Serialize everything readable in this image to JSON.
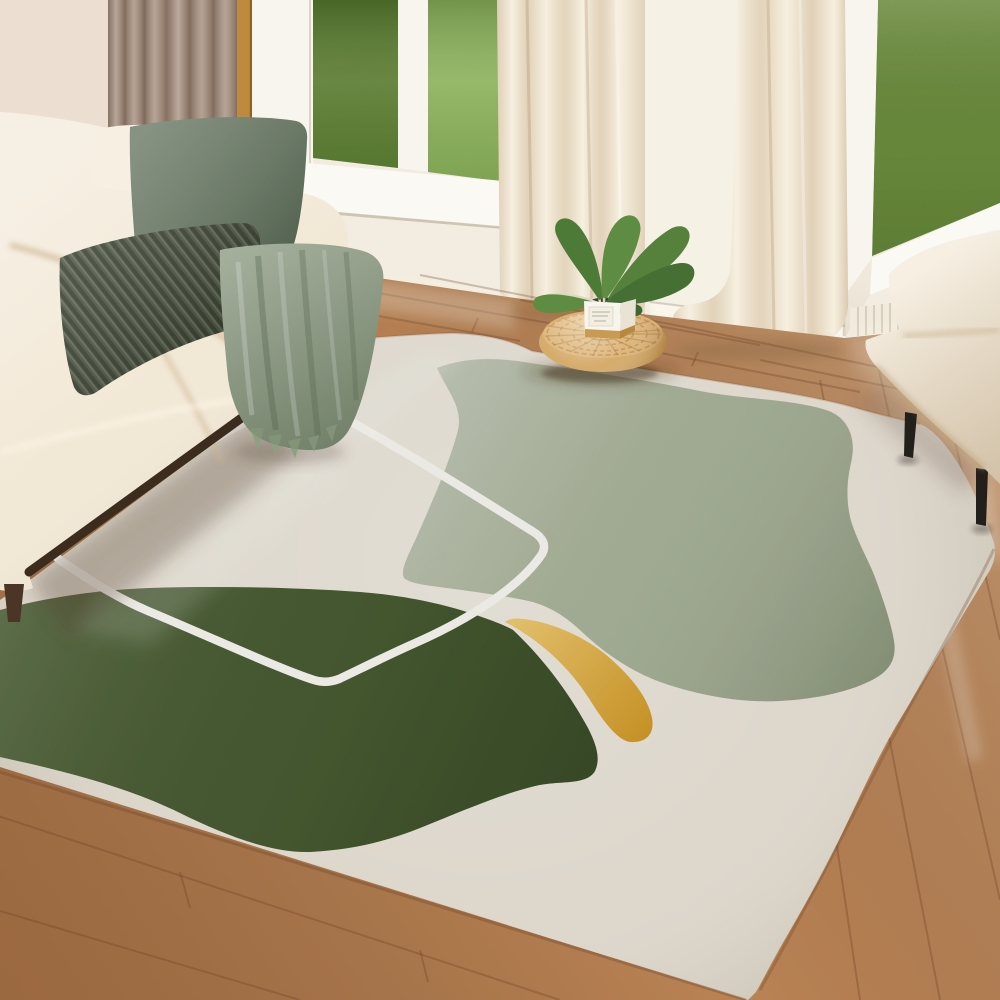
{
  "scene": {
    "description": "Bright living room product photo: cream sofa with green pillows and knit throw, floor-to-ceiling windows with lawn view, rattan pouf with potted plant, cream accent chair, and large abstract area rug with sage and olive blobs, yellow accent and white outline motif",
    "items": [
      "cream-sofa",
      "sage-pillow",
      "corduroy-pillow",
      "knit-throw",
      "taupe-curtain",
      "cream-curtains",
      "lawn-windows",
      "wood-floor",
      "area-rug",
      "sage-blob",
      "olive-blob",
      "yellow-accent",
      "white-outline",
      "rattan-pouf",
      "potted-plant",
      "accent-chair"
    ]
  },
  "palette": {
    "wall": "#f0e9dc",
    "wall_left": "#ecdfd2",
    "curtain_taupe": "#a48d7c",
    "window_trim": "#c08a3e",
    "window_frame": "#f8f5ee",
    "grass_left": "#76a341",
    "grass_right": "#87b14e",
    "sill": "#fbf9f3",
    "curtain_cream": "#f4ead6",
    "wall_pillar": "#f6f1e5",
    "baseboard": "#faf6ec",
    "floor": "#c78c5a",
    "rug_base": "#eae4d8",
    "rug_sage": "#b7c2a5",
    "rug_olive": "#5e7741",
    "rug_yellow": "#e9b335",
    "rug_line": "#f9f7f1",
    "sofa": "#f2e8d6",
    "sofa_rail": "#3b2c1e",
    "sofa_leg": "#4a3526",
    "cushion_white": "#f7f0e2",
    "pillow_sage": "#75866f",
    "pillow_cord": "#4d5541",
    "throw": "#97a78b",
    "pouf": "#d3a763",
    "pot": "#f8f5ee",
    "pot_band": "#c99b52",
    "pot_soil": "#3a3f2e",
    "leaf": "#55813d",
    "chair": "#f1e6d2",
    "chair_leg": "#23201b"
  }
}
